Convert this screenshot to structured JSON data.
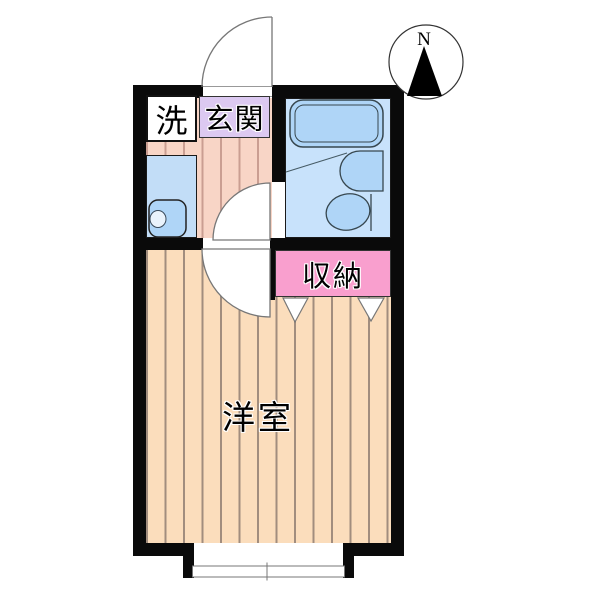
{
  "plan": {
    "type": "apartment-floor-plan",
    "rooms": {
      "laundry": {
        "label": "洗"
      },
      "entrance": {
        "label": "玄関"
      },
      "storage": {
        "label": "収納"
      },
      "western_room": {
        "label": "洋室"
      }
    },
    "fixtures": [
      "bathtub",
      "bath-sink",
      "toilet",
      "washbasin",
      "sliding-window",
      "entrance-door",
      "bathroom-door",
      "room-door",
      "storage-double-doors"
    ],
    "compass": {
      "north_label": "N"
    }
  },
  "colors": {
    "wall": "#0a0a0a",
    "hall_floor": "#F8D5C6",
    "hall_stripe": "#CA9E92",
    "room_floor": "#FBDDBC",
    "room_stripe": "#A18D7E",
    "entrance_bg": "#DCC9F1",
    "storage_bg": "#F99FCE",
    "laundry_bg": "#FFFFFF",
    "washroom_bg": "#C2DDF7",
    "bathroom_bg": "#C8E2FB",
    "fixture_fill": "#AFD5F7",
    "outline": "#3A4A5A",
    "arc_stroke": "#777777"
  }
}
